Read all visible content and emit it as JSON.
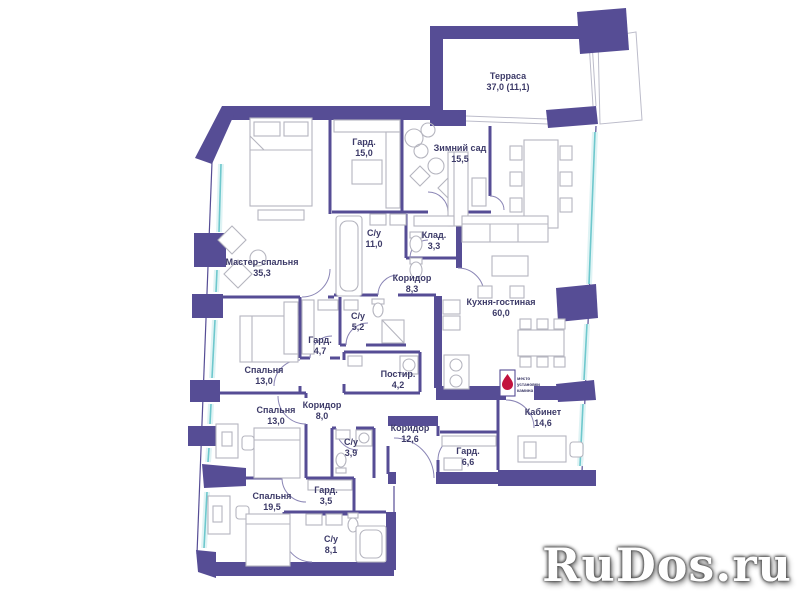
{
  "watermark": {
    "text": "RuDos.ru"
  },
  "colors": {
    "wall": "#564d95",
    "window_glass": "#6ec8cd",
    "window_band": "#dff3f4",
    "furniture": "#b5b5bf",
    "label_text": "#3c3a68",
    "fireplace_flame": "#c2123e",
    "background": "#ffffff"
  },
  "plan": {
    "rooms": [
      {
        "name": "Терраса",
        "area": "37,0 (11,1)"
      },
      {
        "name": "Гард.",
        "area": "15,0"
      },
      {
        "name": "Зимний сад",
        "area": "15,5"
      },
      {
        "name": "Мастер-спальня",
        "area": "35,3"
      },
      {
        "name": "С/у",
        "area": "11,0"
      },
      {
        "name": "Клад.",
        "area": "3,3"
      },
      {
        "name": "Коридор",
        "area": "8,3"
      },
      {
        "name": "Кухня-гостиная",
        "area": "60,0"
      },
      {
        "name": "С/у",
        "area": "5,2"
      },
      {
        "name": "Гард.",
        "area": "4,7"
      },
      {
        "name": "Спальня",
        "area": "13,0"
      },
      {
        "name": "Постир.",
        "area": "4,2"
      },
      {
        "name": "Спальня",
        "area": "13,0"
      },
      {
        "name": "Коридор",
        "area": "8,0"
      },
      {
        "name": "С/у",
        "area": "3,9"
      },
      {
        "name": "Коридор",
        "area": "12,6"
      },
      {
        "name": "Гард.",
        "area": "6,6"
      },
      {
        "name": "Кабинет",
        "area": "14,6"
      },
      {
        "name": "Спальня",
        "area": "19,5"
      },
      {
        "name": "Гард.",
        "area": "3,5"
      },
      {
        "name": "С/у",
        "area": "8,1"
      }
    ],
    "fireplace_note": {
      "line1": "место",
      "line2": "установки",
      "line3": "камина"
    }
  }
}
